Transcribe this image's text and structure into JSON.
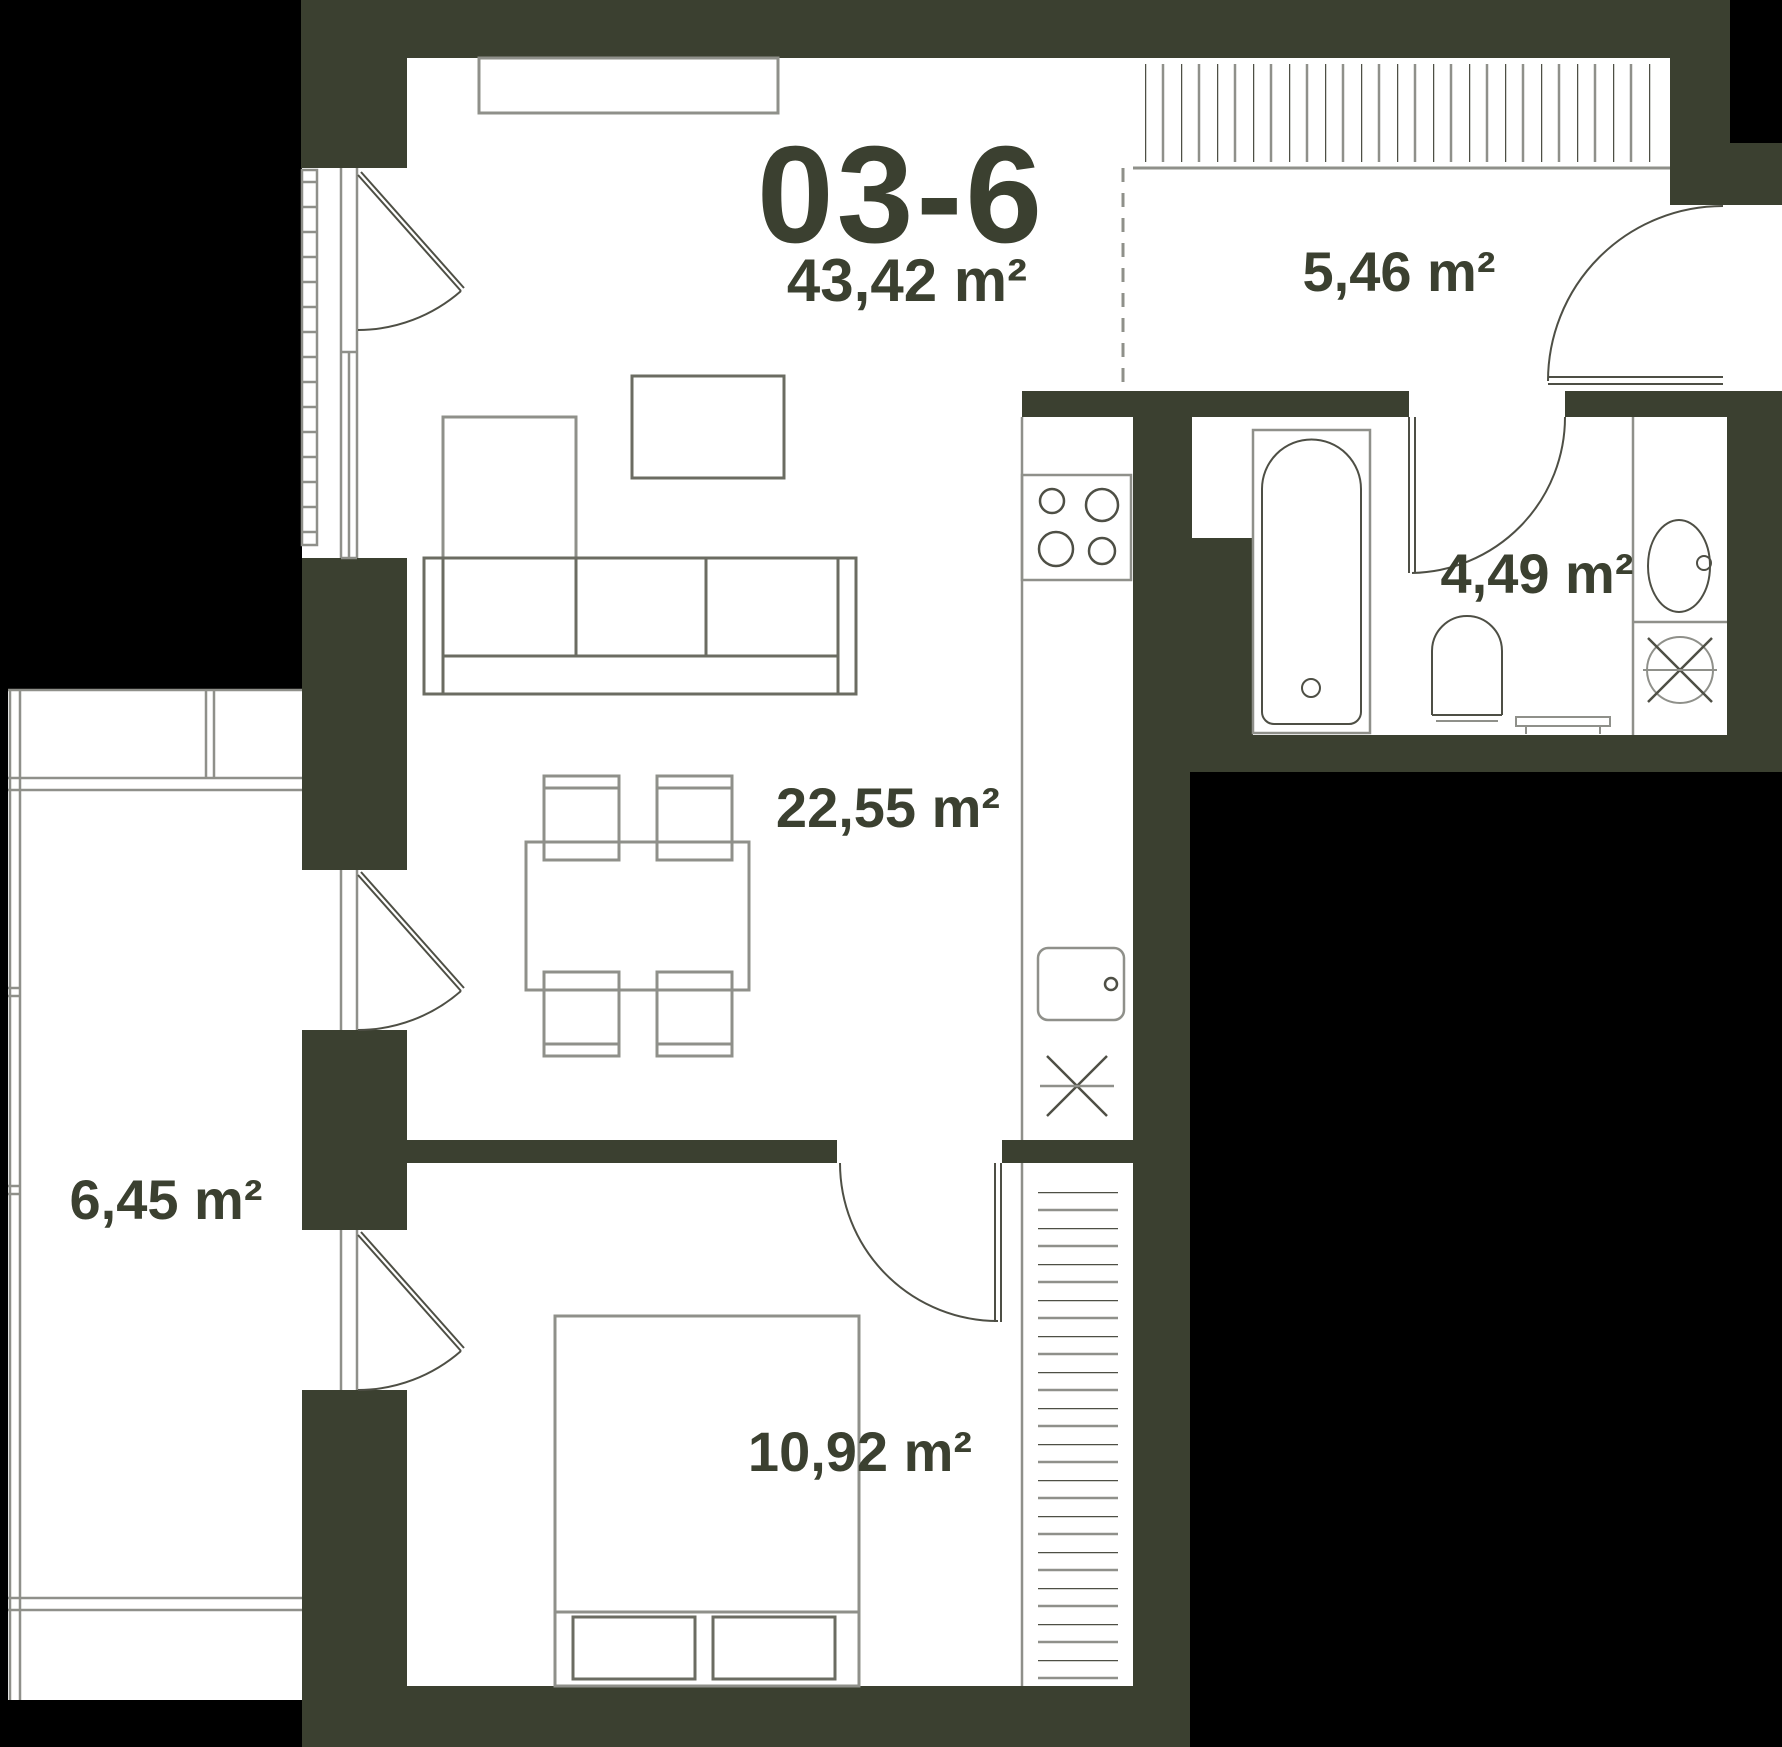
{
  "unit": {
    "code": "03-6",
    "total_area": "43,42 m²"
  },
  "rooms": {
    "living_kitchen": {
      "area": "22,55 m²"
    },
    "hallway": {
      "area": "5,46 m²"
    },
    "bathroom": {
      "area": "4,49 m²"
    },
    "bedroom": {
      "area": "10,92 m²"
    },
    "balcony": {
      "area": "6,45 m²"
    }
  },
  "symbols": [
    "tv-stand-icon",
    "sofa-icon",
    "chaise-icon",
    "coffee-table-icon",
    "dining-table-icon",
    "chair-icon",
    "kitchen-counter-icon",
    "stove-burners-icon",
    "kitchen-sink-icon",
    "extractor-cross-icon",
    "bathtub-icon",
    "toilet-icon",
    "washbasin-icon",
    "washing-machine-icon",
    "bench-icon",
    "bed-icon",
    "pillow-icon",
    "wardrobe-hatch-icon",
    "closet-hatch-icon",
    "door-swing-icon",
    "entrance-door-icon",
    "window-icon",
    "french-balcony-railing-icon",
    "balcony-railing-icon"
  ],
  "colors": {
    "background": "#000000",
    "wall": "#3B4030",
    "floor": "#FFFFFF",
    "line_light": "#8F908A",
    "line_dark": "#4E4F45",
    "text": "#3B4030"
  }
}
